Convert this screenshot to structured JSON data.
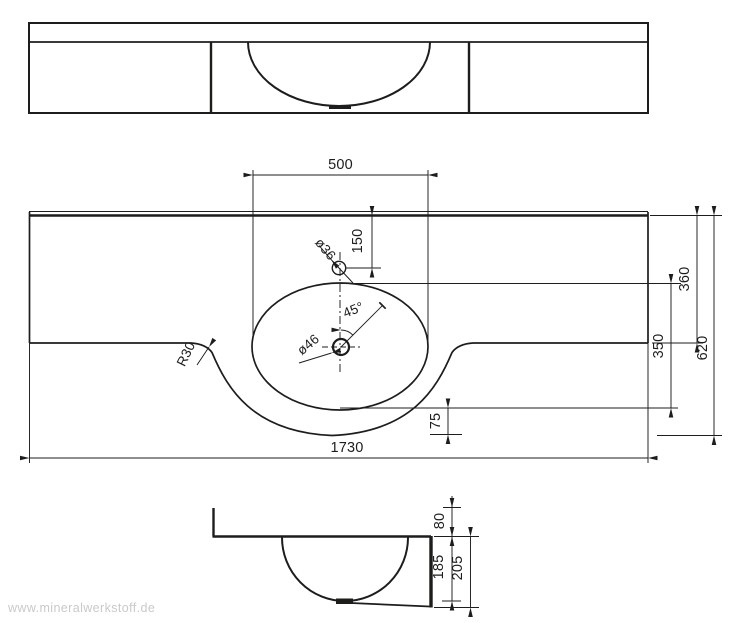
{
  "watermark": {
    "text": "www.mineralwerkstoff.de"
  },
  "dimensions": {
    "basin_width": "500",
    "tap_offset": "150",
    "tap_hole_diameter": "ø36",
    "drain_diameter": "ø46",
    "drain_angle": "45°",
    "corner_radius": "R30",
    "wing_depth": "360",
    "basin_front_depth": "350",
    "total_depth": "620",
    "front_overhang": "75",
    "total_width": "1730",
    "upstand_height": "80",
    "bowl_depth": "185",
    "front_apron_height": "205"
  },
  "colors": {
    "line": "#1d1d1b",
    "watermark": "#c9c9c9",
    "background": "#ffffff"
  }
}
